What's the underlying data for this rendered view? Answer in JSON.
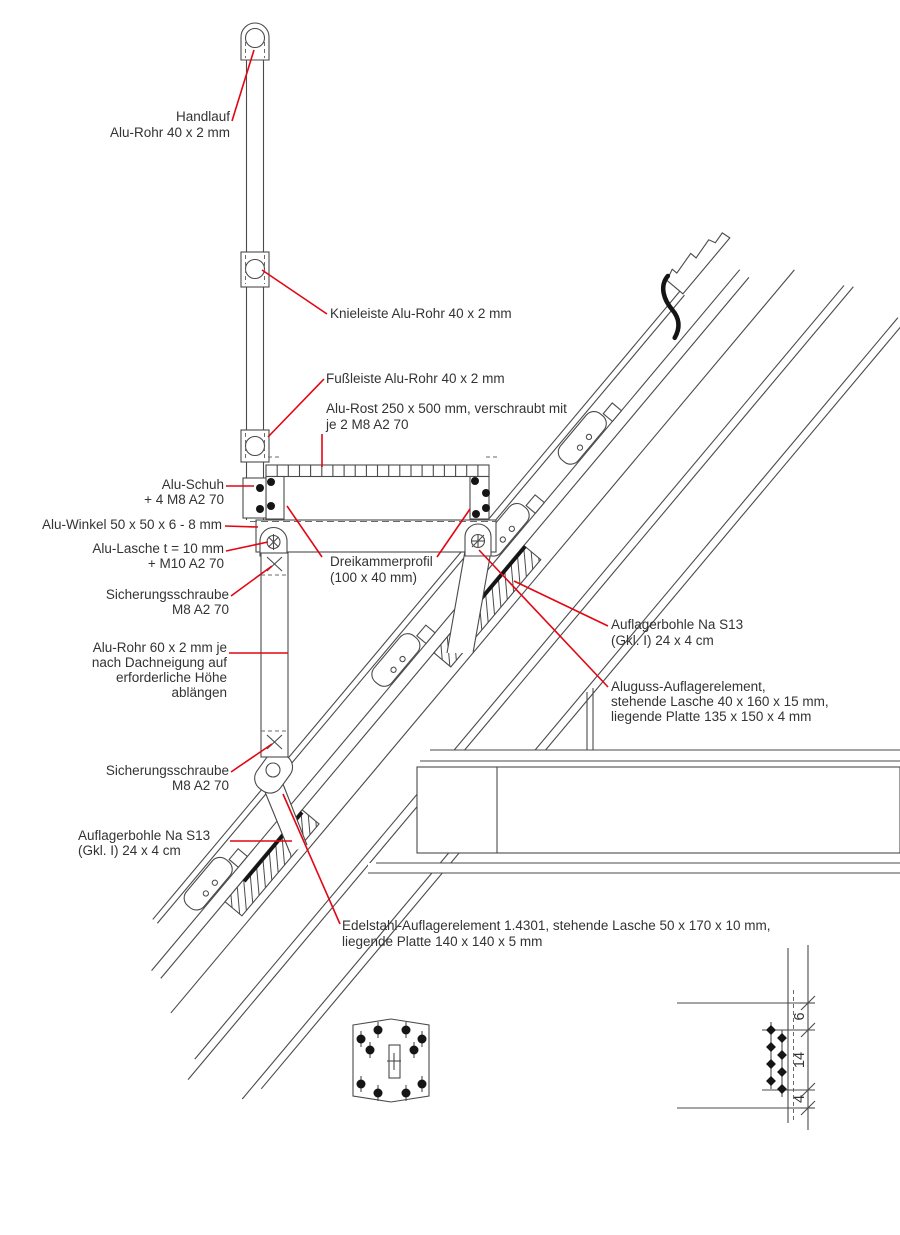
{
  "drawing": {
    "title": "Seitenschutz-Detail Dachfenster (technische Zeichnung)",
    "colors": {
      "line": "#4a4a4a",
      "leader": "#e30613",
      "text": "#333333",
      "background": "#ffffff"
    },
    "labels": {
      "handlauf": [
        "Handlauf",
        "Alu-Rohr 40 x 2 mm"
      ],
      "knieleiste": [
        "Knieleiste Alu-Rohr 40 x 2 mm"
      ],
      "fussleiste": [
        "Fußleiste Alu-Rohr 40 x 2 mm"
      ],
      "alurost": [
        "Alu-Rost 250 x 500 mm, verschraubt mit",
        "je 2 M8 A2 70"
      ],
      "aluschuh": [
        "Alu-Schuh",
        "+ 4 M8 A2 70"
      ],
      "aluwinkel": [
        "Alu-Winkel 50 x 50 x 6 - 8 mm"
      ],
      "alulasche": [
        "Alu-Lasche t = 10 mm",
        "+ M10 A2 70"
      ],
      "sicherung1": [
        "Sicherungsschraube",
        "M8 A2 70"
      ],
      "alurohr60": [
        "Alu-Rohr 60 x 2 mm je",
        "nach Dachneigung auf",
        "erforderliche Höhe",
        "ablängen"
      ],
      "sicherung2": [
        "Sicherungsschraube",
        "M8 A2 70"
      ],
      "dreikammer": [
        "Dreikammerprofil",
        "(100 x 40 mm)"
      ],
      "auflagerbohle_rechts": [
        "Auflagerbohle Na S13",
        "(Gkl. I) 24 x 4 cm"
      ],
      "aluguss": [
        "Aluguss-Auflagerelement,",
        "stehende Lasche 40 x 160 x 15 mm,",
        "liegende Platte 135 x 150 x 4 mm"
      ],
      "auflagerbohle_links": [
        "Auflagerbohle Na S13",
        "(Gkl. I) 24 x 4 cm"
      ],
      "edelstahl": [
        "Edelstahl-Auflagerelement 1.4301, stehende Lasche 50 x 170 x 10 mm,",
        "liegende Platte 140 x 140 x 5 mm"
      ]
    },
    "dimensions": {
      "top": "6",
      "middle": "14",
      "bottom": "4"
    }
  }
}
